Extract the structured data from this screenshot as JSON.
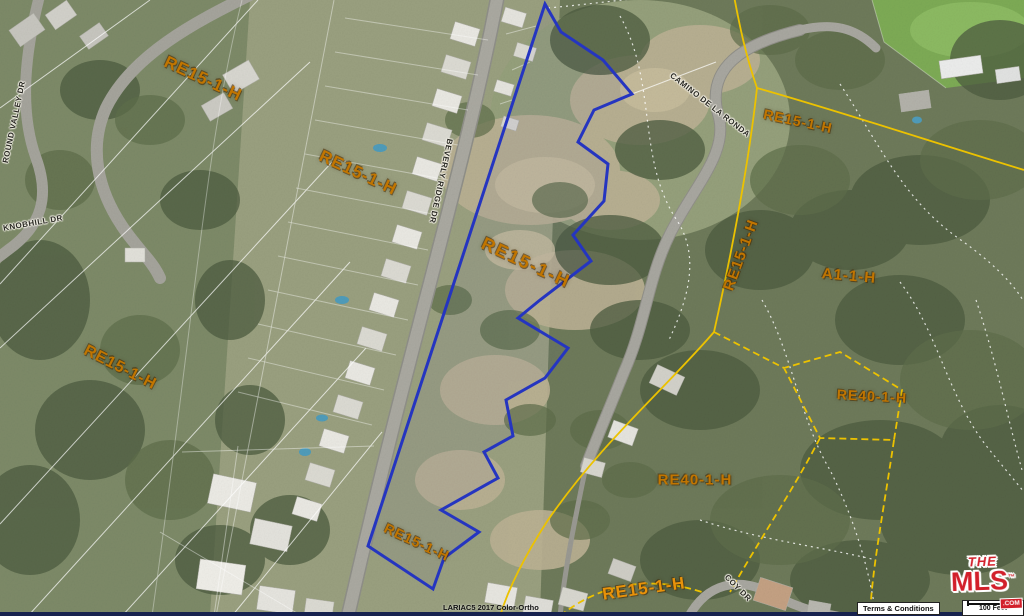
{
  "map": {
    "zoning_labels": [
      {
        "text": "RE15-1-H"
      },
      {
        "text": "RE15-1-H"
      },
      {
        "text": "RE15-1-H"
      },
      {
        "text": "RE15-1-H"
      },
      {
        "text": "RE15-1-H"
      },
      {
        "text": "A1-1-H"
      },
      {
        "text": "RE40-1-H"
      },
      {
        "text": "RE40-1-H"
      },
      {
        "text": "RE15-1-H"
      },
      {
        "text": "RE15-1-H"
      },
      {
        "text": "RE15-1-H"
      }
    ],
    "street_labels": [
      {
        "text": "ROUND VALLEY DR"
      },
      {
        "text": "KNOBHILL DR"
      },
      {
        "text": "BEVERLY RIDGE DR"
      },
      {
        "text": "CAMINO DE LA RONDA"
      },
      {
        "text": "COY DR"
      }
    ],
    "colors": {
      "subject_parcel_outline": "#2535c0",
      "zoning_label": "#c17500",
      "zoning_boundary": "#ecc200",
      "parcel_line": "#ffffff"
    }
  },
  "footer": {
    "imagery_credit": "LARIAC5 2017 Color-Ortho",
    "terms_label": "Terms & Conditions",
    "scale_label": "100 Feet"
  },
  "logo": {
    "the": "THE",
    "mls": "MLS",
    "tm": "™",
    "com": ".COM"
  }
}
